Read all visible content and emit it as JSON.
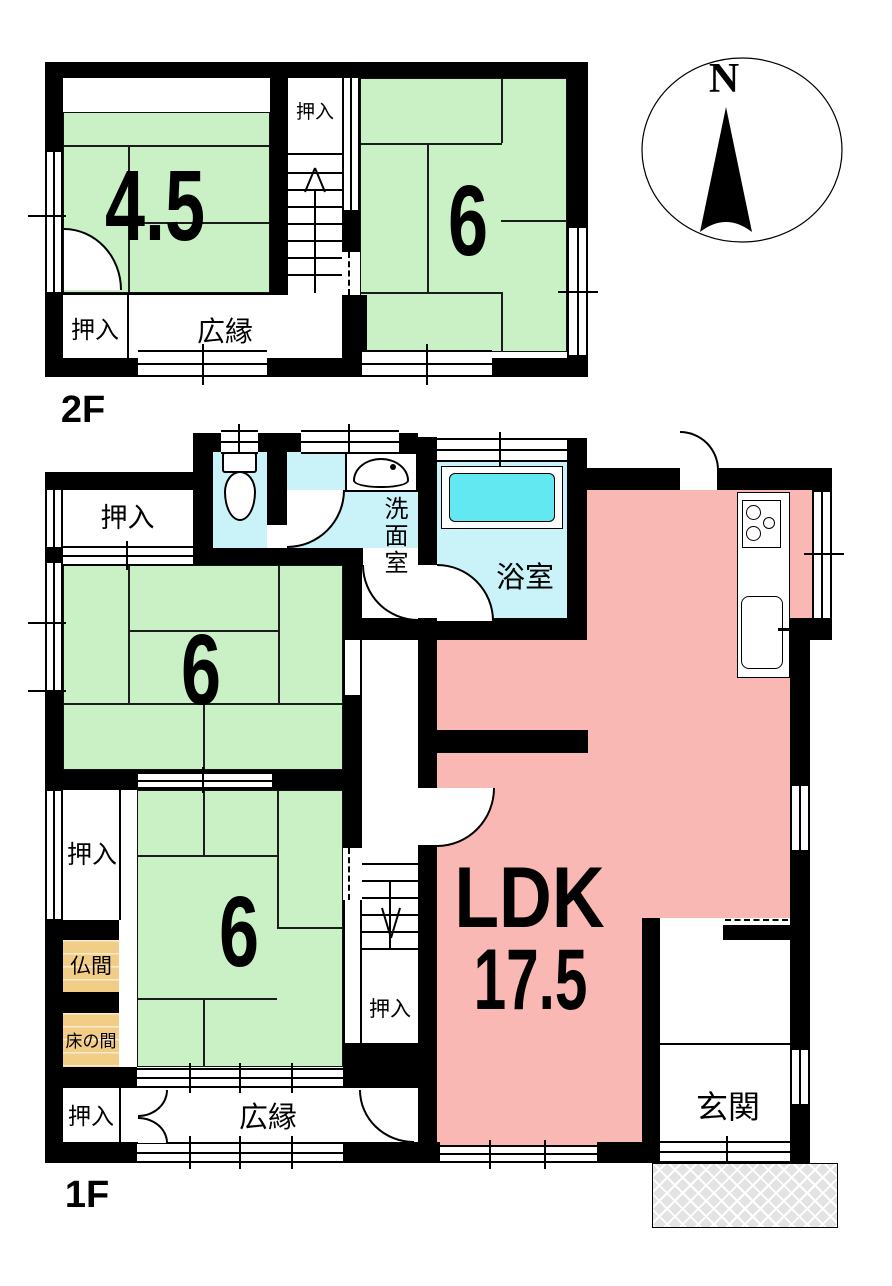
{
  "compass": {
    "north": "N"
  },
  "floor_2f": {
    "name": "2F",
    "room_45": "4.5",
    "room_6": "6",
    "closet_top": "押入",
    "closet_bottom": "押入",
    "veranda": "広縁"
  },
  "floor_1f": {
    "name": "1F",
    "room_6_upper": "6",
    "room_6_lower": "6",
    "ldk": "LDK",
    "ldk_area": "17.5",
    "washroom": "洗面室",
    "bathroom": "浴室",
    "closet_top": "押入",
    "closet_left": "押入",
    "closet_stairs": "押入",
    "closet_bottom": "押入",
    "butsuma": "仏間",
    "tokonoma": "床の間",
    "veranda": "広縁",
    "entrance": "玄関"
  },
  "colors": {
    "tatami": "#c9f1c5",
    "ldk": "#f9b8b3",
    "wet_room": "#c9f3f8",
    "bathtub": "#61e8f0",
    "alcove": "#f2cd85",
    "wall": "#000000",
    "porch_fill": "#e3e3e3"
  }
}
